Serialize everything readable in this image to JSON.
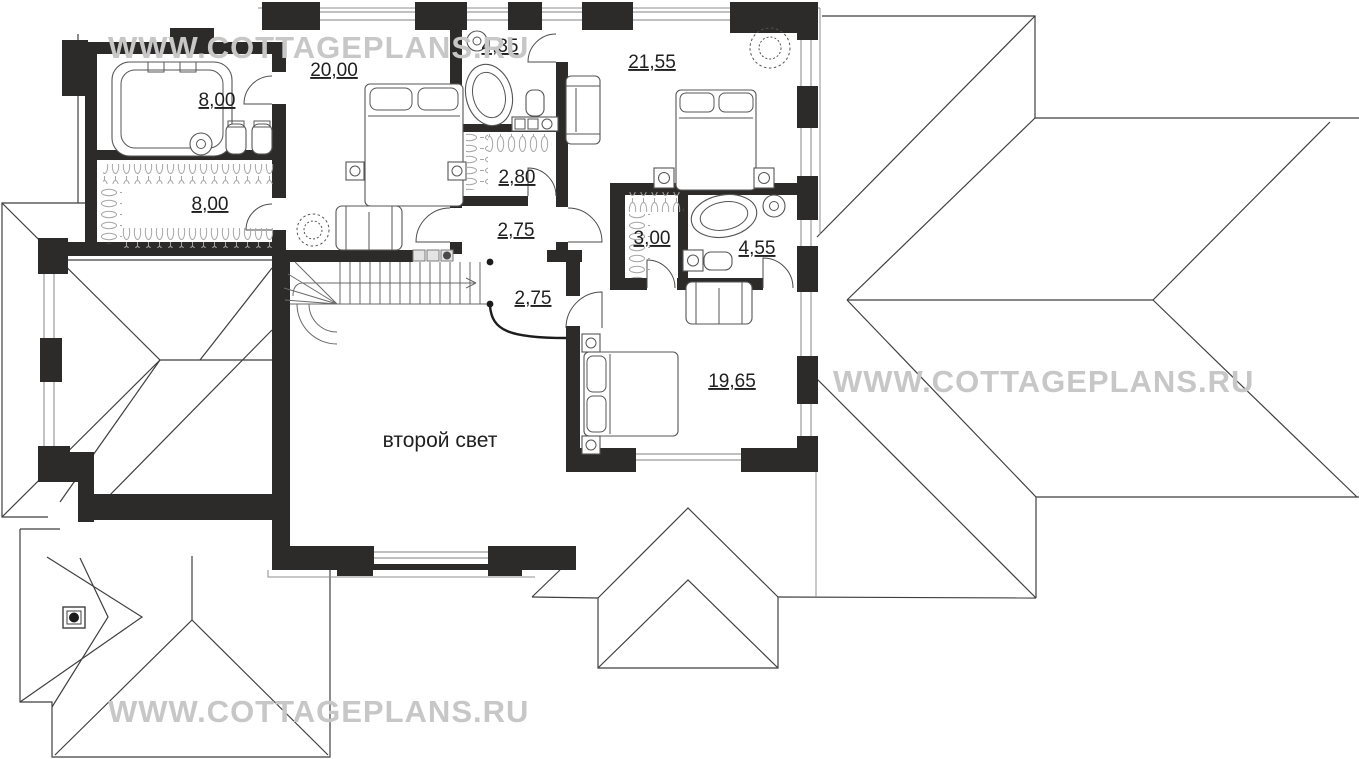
{
  "plan": {
    "type": "second-floor-plan",
    "second_light_label": "второй свет",
    "rooms": [
      {
        "id": "sauna-room",
        "area": "8,00"
      },
      {
        "id": "wardrobe-room",
        "area": "8,00"
      },
      {
        "id": "bedroom-1",
        "area": "20,00"
      },
      {
        "id": "bathroom-1",
        "area": "4,35"
      },
      {
        "id": "closet-1",
        "area": "2,80"
      },
      {
        "id": "hall-1",
        "area": "2,75"
      },
      {
        "id": "bedroom-2",
        "area": "21,55"
      },
      {
        "id": "closet-2",
        "area": "3,00"
      },
      {
        "id": "bathroom-2",
        "area": "4,55"
      },
      {
        "id": "hall-2",
        "area": "2,75"
      },
      {
        "id": "bedroom-3",
        "area": "19,65"
      }
    ]
  },
  "watermark": {
    "text": "WWW.COTTAGEPLANS.RU",
    "color": "#c7c7c7"
  },
  "colors": {
    "walls": "#2d2b29",
    "roof_lines": "#3f3f3f",
    "window_lines": "#9b9b9b",
    "labels": "#1f1f1f",
    "background": "#ffffff"
  }
}
